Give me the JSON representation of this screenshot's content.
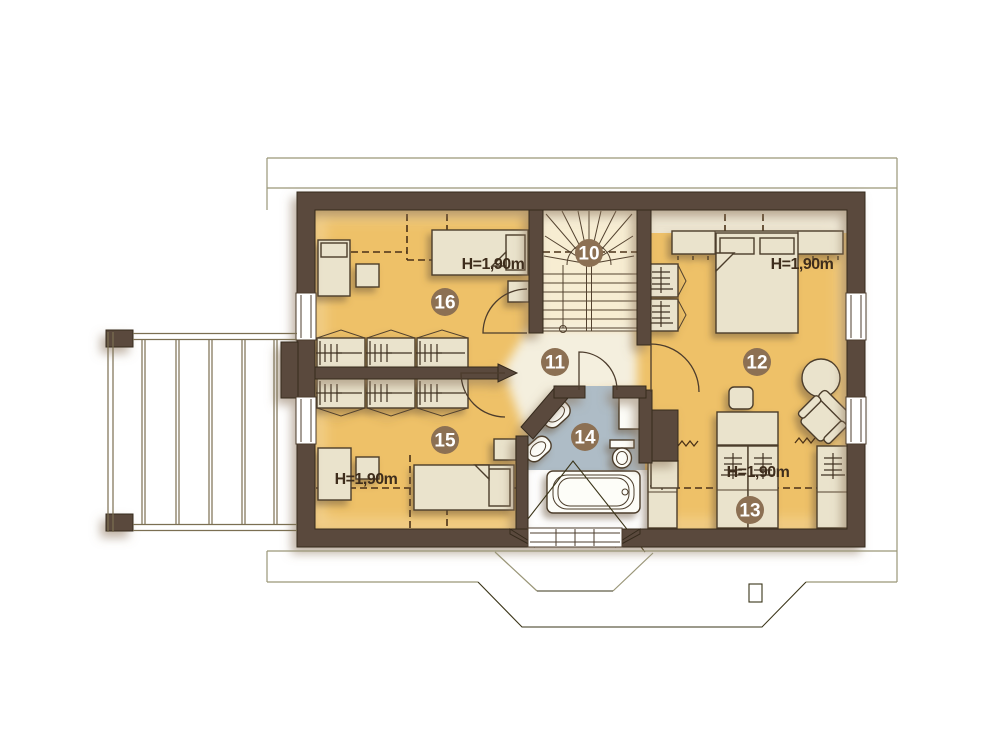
{
  "plan": {
    "rooms": [
      {
        "number": "10"
      },
      {
        "number": "11"
      },
      {
        "number": "12",
        "height_label": "H=1,90m"
      },
      {
        "number": "13",
        "height_label": "H=1,90m"
      },
      {
        "number": "14"
      },
      {
        "number": "15",
        "height_label": "H=1,90m"
      },
      {
        "number": "16",
        "height_label": "H=1,90m"
      }
    ]
  },
  "colors": {
    "wall": "#5a4a3d",
    "floor": "#eec168",
    "floor_light_strip": "#ece4cf",
    "stairs_floor": "#f7edd2",
    "hall_floor": "#f4efde",
    "bathroom_floor": "#aebcc6",
    "under_eave_floor": "#fefefe",
    "furniture": "#eae3cc",
    "furniture_outline": "#4c3c2c",
    "badge": "#8c7053",
    "badge_text": "#ffffff",
    "label_text": "#3e2d1c",
    "roof_line_light": "#9a9678",
    "roof_line_dark": "#3a3418",
    "terrace_line": "#7b6f52"
  }
}
